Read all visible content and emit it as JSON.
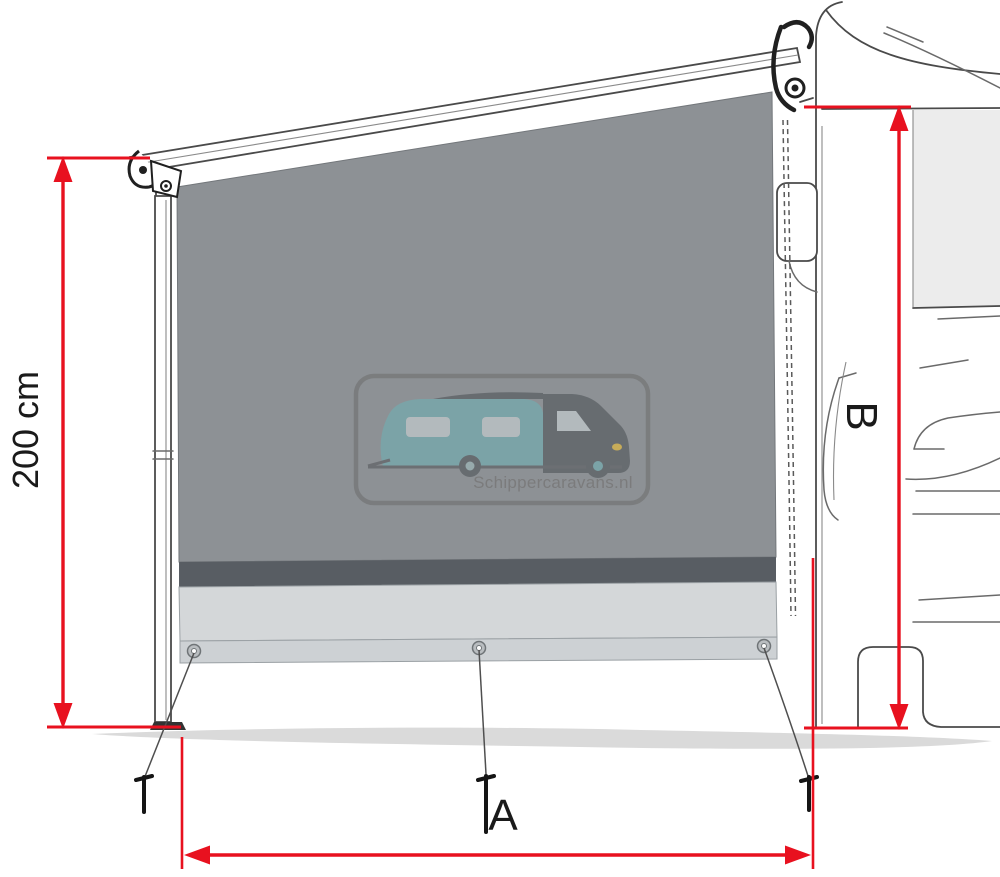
{
  "diagram": {
    "labels": {
      "height": "200 cm",
      "width": "A",
      "vehicle_height": "B"
    },
    "watermark": {
      "text": "Schippercaravans.nl"
    },
    "colors": {
      "dimension_red": "#e8111f",
      "fabric_gray": "#8d9195",
      "fabric_dark_band": "#585d63",
      "skirt_light": "#d4d7d9",
      "ground_gray": "#dadada",
      "window_gray": "#ececec",
      "line_art": "#4a4a4a",
      "watermark_teal": "#6fb0b4",
      "watermark_dark": "#4d5257",
      "headlight_yellow": "#f2c12e"
    }
  }
}
